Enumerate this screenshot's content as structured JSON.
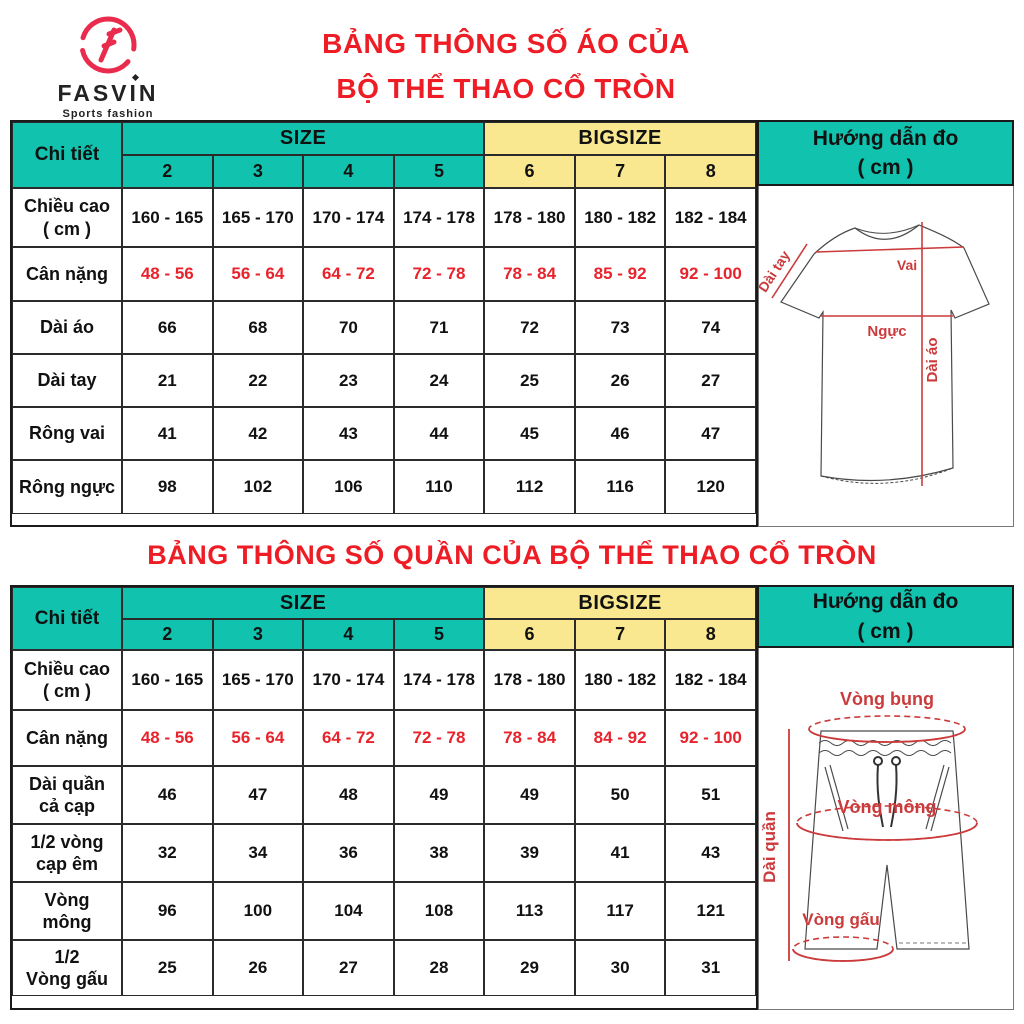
{
  "logo": {
    "brand": "FASVIN",
    "tagline": "Sports fashion"
  },
  "titles": {
    "shirt_line1": "BẢNG THÔNG SỐ ÁO CỦA",
    "shirt_line2": "BỘ THỂ THAO CỔ TRÒN",
    "pants": "BẢNG THÔNG SỐ QUẦN CỦA BỘ THỂ THAO CỔ TRÒN"
  },
  "colors": {
    "teal": "#11c3ae",
    "yellow": "#f9e88f",
    "title_red": "#ee1c24",
    "value_red": "#e8232b",
    "diagram_red": "#cc3b3b",
    "logo_red": "#e92c4d"
  },
  "header": {
    "chi_tiet": "Chi tiết",
    "size": "SIZE",
    "bigsize": "BIGSIZE",
    "size_cols": [
      "2",
      "3",
      "4",
      "5"
    ],
    "bigsize_cols": [
      "6",
      "7",
      "8"
    ],
    "guide_line1": "Hướng dẫn đo",
    "guide_line2": "( cm )"
  },
  "shirt_table": {
    "rows": [
      {
        "label1": "Chiều cao",
        "label2": "( cm )",
        "red": false,
        "values": [
          "160 - 165",
          "165 - 170",
          "170 - 174",
          "174 - 178",
          "178 - 180",
          "180 - 182",
          "182 - 184"
        ]
      },
      {
        "label1": "Cân nặng",
        "label2": "",
        "red": true,
        "values": [
          "48 - 56",
          "56 - 64",
          "64 - 72",
          "72 - 78",
          "78 - 84",
          "85 - 92",
          "92 - 100"
        ]
      },
      {
        "label1": "Dài áo",
        "label2": "",
        "red": false,
        "values": [
          "66",
          "68",
          "70",
          "71",
          "72",
          "73",
          "74"
        ]
      },
      {
        "label1": "Dài tay",
        "label2": "",
        "red": false,
        "values": [
          "21",
          "22",
          "23",
          "24",
          "25",
          "26",
          "27"
        ]
      },
      {
        "label1": "Rông vai",
        "label2": "",
        "red": false,
        "values": [
          "41",
          "42",
          "43",
          "44",
          "45",
          "46",
          "47"
        ]
      },
      {
        "label1": "Rông ngực",
        "label2": "",
        "red": false,
        "values": [
          "98",
          "102",
          "106",
          "110",
          "112",
          "116",
          "120"
        ]
      }
    ]
  },
  "pants_table": {
    "rows": [
      {
        "label1": "Chiều cao",
        "label2": "( cm )",
        "red": false,
        "values": [
          "160 - 165",
          "165 - 170",
          "170 - 174",
          "174 - 178",
          "178 - 180",
          "180 - 182",
          "182 - 184"
        ]
      },
      {
        "label1": "Cân nặng",
        "label2": "",
        "red": true,
        "values": [
          "48 - 56",
          "56 - 64",
          "64 - 72",
          "72 - 78",
          "78 - 84",
          "84 - 92",
          "92 - 100"
        ]
      },
      {
        "label1": "Dài quần",
        "label2": "cả cạp",
        "red": false,
        "values": [
          "46",
          "47",
          "48",
          "49",
          "49",
          "50",
          "51"
        ]
      },
      {
        "label1": "1/2 vòng",
        "label2": "cạp êm",
        "red": false,
        "values": [
          "32",
          "34",
          "36",
          "38",
          "39",
          "41",
          "43"
        ]
      },
      {
        "label1": "Vòng",
        "label2": "mông",
        "red": false,
        "values": [
          "96",
          "100",
          "104",
          "108",
          "113",
          "117",
          "121"
        ]
      },
      {
        "label1": "1/2",
        "label2": "Vòng gấu",
        "red": false,
        "values": [
          "25",
          "26",
          "27",
          "28",
          "29",
          "30",
          "31"
        ]
      }
    ]
  },
  "shirt_diagram": {
    "vai": "Vai",
    "dai_tay": "Dài tay",
    "nguc": "Ngực",
    "dai_ao": "Dài áo"
  },
  "pants_diagram": {
    "vong_bung": "Vòng bụng",
    "vong_mong": "Vòng mông",
    "dai_quan": "Dài quần",
    "vong_gau": "Vòng gấu"
  }
}
